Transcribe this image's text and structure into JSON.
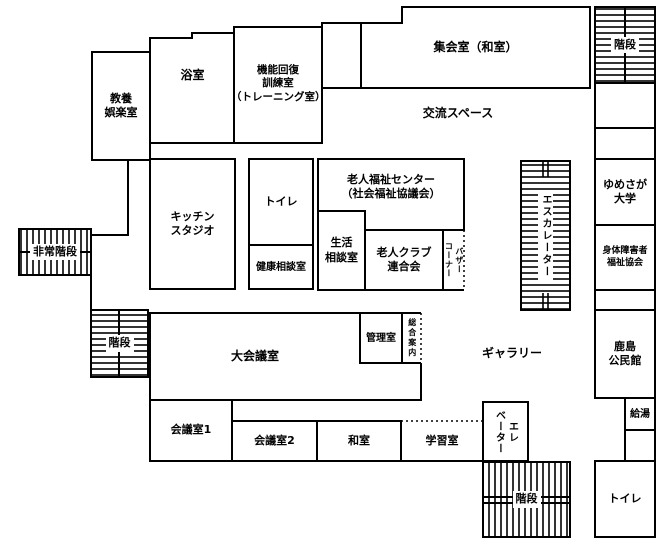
{
  "colors": {
    "wall": "#000000",
    "background": "#ffffff",
    "text": "#000000"
  },
  "rooms": {
    "kyoyo_goraku": {
      "label": "教養\n娯楽室"
    },
    "yokushitsu": {
      "label": "浴室"
    },
    "kinou_kaifuku": {
      "label": "機能回復\n訓練室\n（トレーニング室）"
    },
    "shukaishitsu": {
      "label": "集会室（和室）"
    },
    "kouryuu_space": {
      "label": "交流スペース"
    },
    "kitchen_studio": {
      "label": "キッチン\nスタジオ"
    },
    "toilet_center": {
      "label": "トイレ"
    },
    "kenkou_soudan": {
      "label": "健康相談室"
    },
    "roujin_fukushi_center": {
      "label": "老人福祉センター\n（社会福祉協議会）"
    },
    "seikatsu_soudan": {
      "label": "生活\n相談室"
    },
    "roujin_club": {
      "label": "老人クラブ\n連合会"
    },
    "bazaar_corner": {
      "lines": [
        "バザー",
        "コーナー"
      ]
    },
    "yumesaga_univ": {
      "label": "ゆめさが\n大学"
    },
    "shintai_fukushi": {
      "label": "身体障害者\n福祉協会"
    },
    "kashima_kouminkan": {
      "label": "鹿島\n公民館"
    },
    "kyutou": {
      "label": "給湯"
    },
    "toilet_right": {
      "label": "トイレ"
    },
    "dai_kaigishitsu": {
      "label": "大会議室"
    },
    "kanrishitsu": {
      "label": "管理室"
    },
    "sougou_annai": {
      "label": "総合案内"
    },
    "gallery": {
      "label": "ギャラリー"
    },
    "kaigishitsu1": {
      "label": "会議室1"
    },
    "kaigishitsu2": {
      "label": "会議室2"
    },
    "washitsu": {
      "label": "和室"
    },
    "gakushuushitsu": {
      "label": "学習室"
    }
  },
  "circulation": {
    "stairs_top_right": {
      "label": "階段"
    },
    "stairs_left": {
      "label": "階段"
    },
    "stairs_bottom": {
      "label": "階段"
    },
    "emergency_stairs": {
      "label": "非常階段"
    },
    "escalator": {
      "label": "エスカレーター"
    },
    "elevator": {
      "lines": [
        "エレ",
        "ベーター"
      ]
    }
  }
}
